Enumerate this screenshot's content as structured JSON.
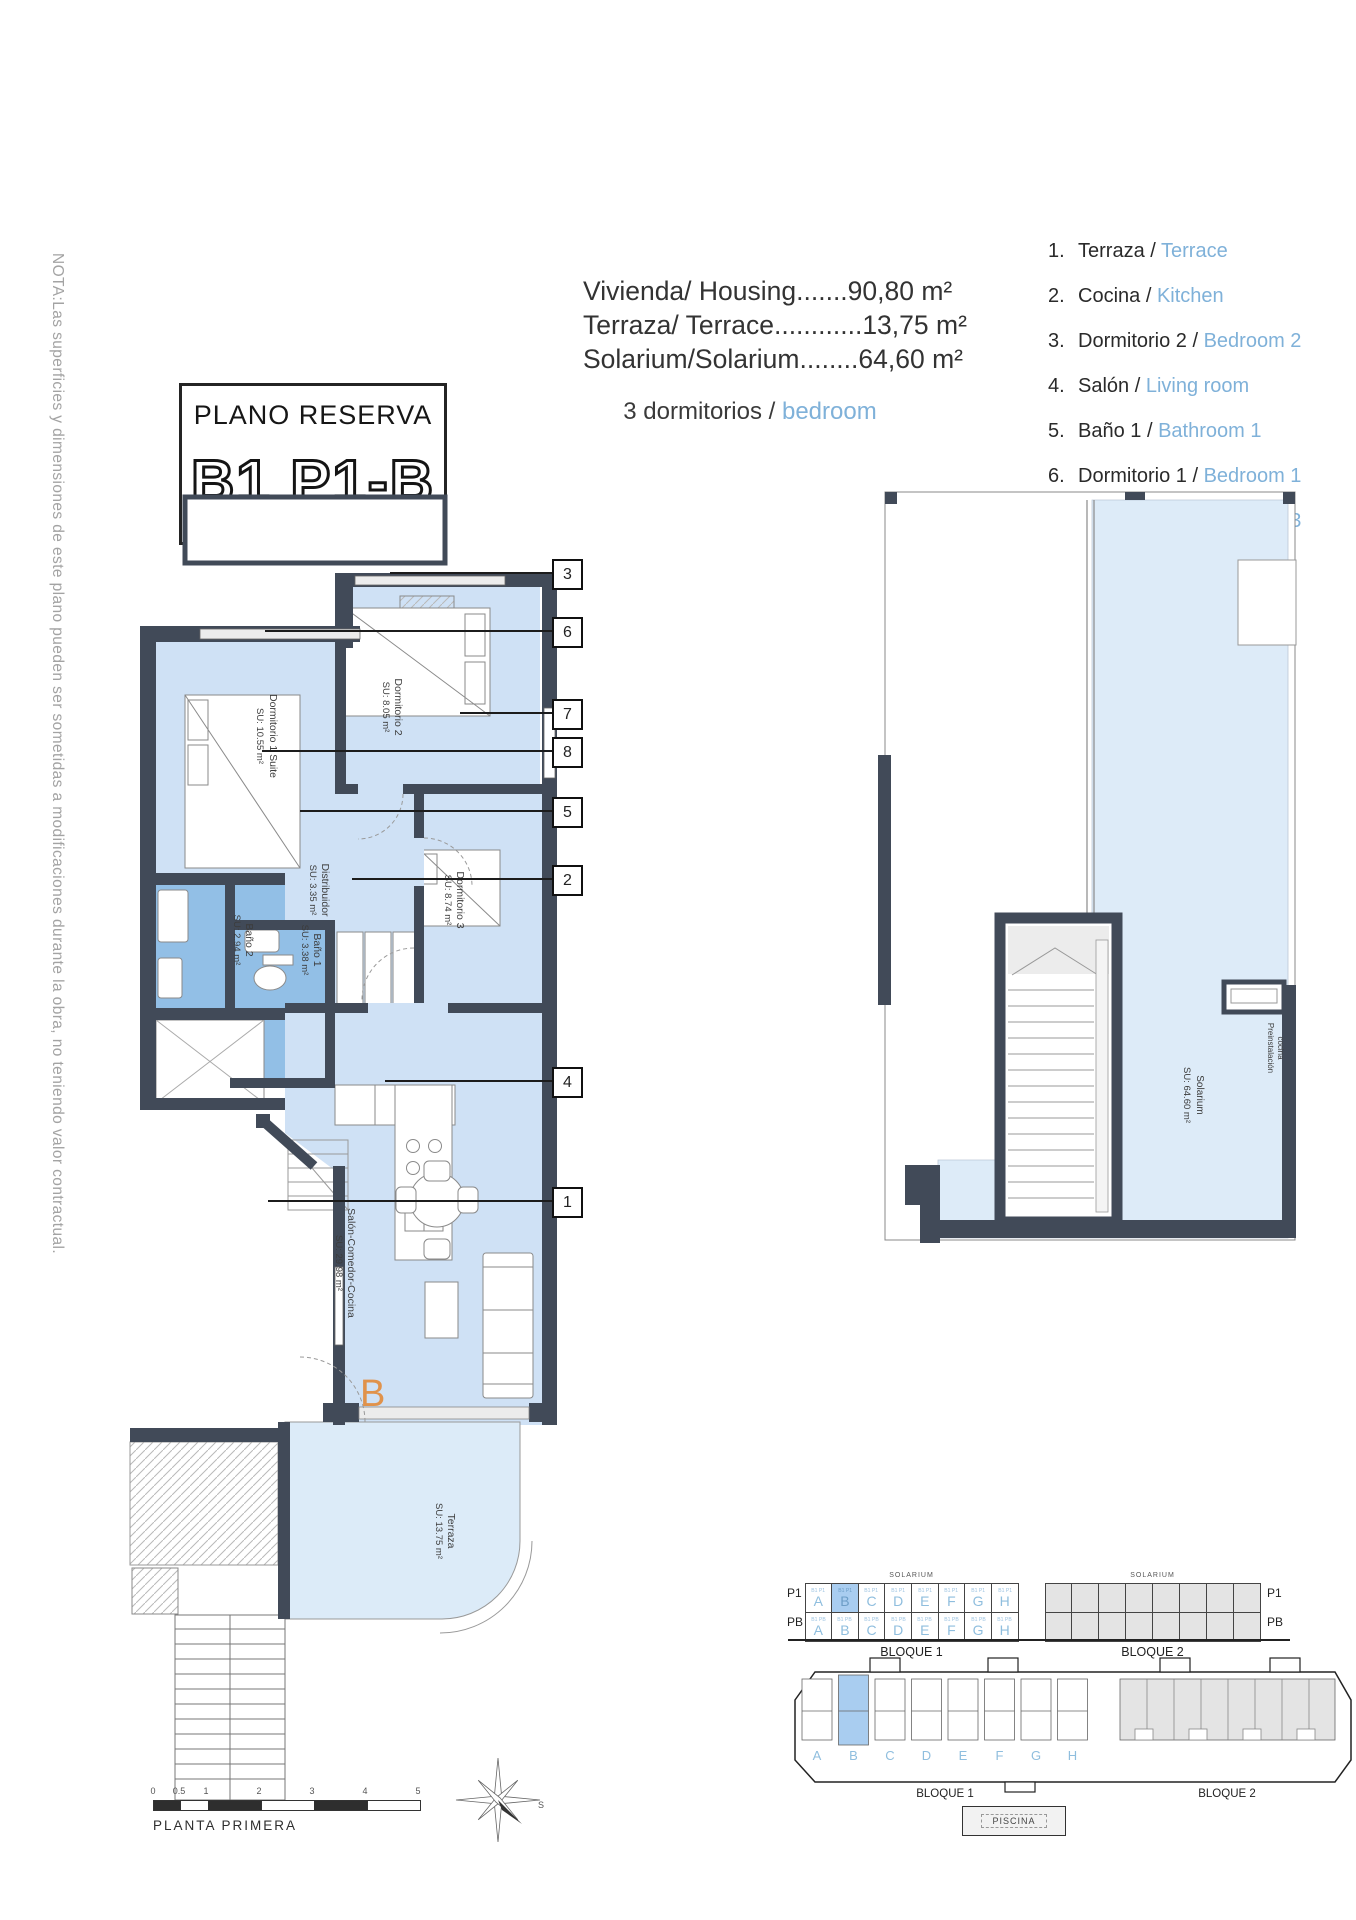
{
  "note": "NOTA:Las superficies y dimensiones de este plano pueden ser sometidas a modificaciones durante la obra, no teniendo valor contractual.",
  "title_block": {
    "title": "PLANO RESERVA",
    "code": "B1 P1-B"
  },
  "areas": {
    "lines": [
      "Vivienda/ Housing.......90,80 m²",
      "Terraza/ Terrace............13,75 m²",
      "Solarium/Solarium........64,60 m²"
    ],
    "bedrooms_es": "3 dormitorios / ",
    "bedrooms_en": "bedroom"
  },
  "legend": [
    {
      "n": "1.",
      "es": "Terraza / ",
      "en": "Terrace"
    },
    {
      "n": "2.",
      "es": "Cocina / ",
      "en": "Kitchen"
    },
    {
      "n": "3.",
      "es": "Dormitorio 2 / ",
      "en": "Bedroom 2"
    },
    {
      "n": "4.",
      "es": "Salón / ",
      "en": "Living room"
    },
    {
      "n": "5.",
      "es": "Baño 1 / ",
      "en": "Bathroom 1"
    },
    {
      "n": "6.",
      "es": "Dormitorio 1 / ",
      "en": "Bedroom 1"
    },
    {
      "n": "7.",
      "es": "Dormitorio 3 / ",
      "en": "Bedroom 3"
    },
    {
      "n": "8.",
      "es": "Baño 2 / ",
      "en": "Bathroom 2"
    }
  ],
  "plan": {
    "rooms": {
      "dorm1": {
        "name": "Dormitorio 1 Suite",
        "su": "SU: 10.55 m²"
      },
      "dorm2": {
        "name": "Dormitorio 2",
        "su": "SU: 8.05 m²"
      },
      "dorm3": {
        "name": "Dormitorio 3",
        "su": "SU: 8.74 m²"
      },
      "distribuidor": {
        "name": "Distribuidor",
        "su": "SU: 3.35 m²"
      },
      "bano1": {
        "name": "Baño 1",
        "su": "SU: 3.38 m²"
      },
      "bano2": {
        "name": "Baño 2",
        "su": "SU: 2.94 m²"
      },
      "salon": {
        "name": "Salón-Comedor-Cocina",
        "su": "SU: 29.98 m²"
      },
      "terraza": {
        "name": "Terraza",
        "su": "SU: 13.75 m²"
      }
    },
    "unit_letter": "B",
    "callouts": [
      "3",
      "6",
      "7",
      "8",
      "5",
      "2",
      "4",
      "1"
    ]
  },
  "solarium_plan": {
    "name": "Solarium",
    "su": "SU: 64.60 m²",
    "note_line1": "Preinstalación",
    "note_line2": "cocina"
  },
  "schematic": {
    "row_p1": "P1",
    "row_pb": "PB",
    "solarium": "SOLARIUM",
    "bloque1": "BLOQUE 1",
    "bloque2": "BLOQUE 2",
    "sub_p1": "B1 P1",
    "sub_pb": "B1 PB",
    "letters": [
      "A",
      "B",
      "C",
      "D",
      "E",
      "F",
      "G",
      "H"
    ]
  },
  "site_plan": {
    "letters": [
      "A",
      "B",
      "C",
      "D",
      "E",
      "F",
      "G",
      "H"
    ],
    "bloque1": "BLOQUE 1",
    "bloque2": "BLOQUE 2",
    "piscina": "PISCINA"
  },
  "scale_bar": {
    "ticks": [
      "0",
      "0.5",
      "1",
      "2",
      "3",
      "4",
      "5"
    ],
    "label": "PLANTA PRIMERA"
  },
  "compass": {
    "s": "S"
  },
  "colors": {
    "wall": "#414a58",
    "room_blue": "#cfe1f5",
    "bath_blue": "#92bfe6",
    "terrace_blue": "#dcebf8",
    "highlight_blue": "#a9cdf0",
    "accent_text_blue": "#7fb1d9",
    "unit_orange": "#e0924b"
  }
}
